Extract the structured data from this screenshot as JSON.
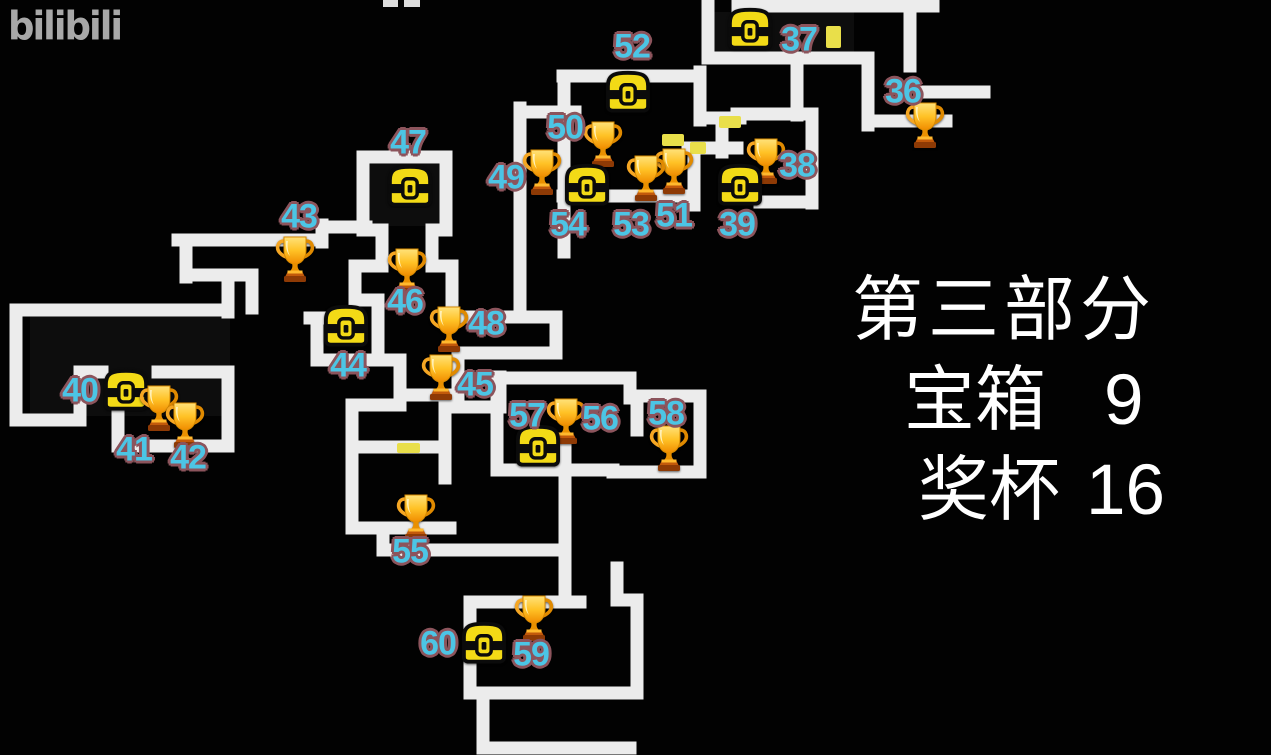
{
  "watermark": {
    "text": "bilibili"
  },
  "panel": {
    "title": "第三部分",
    "rows": [
      {
        "label": "宝箱",
        "value": "9"
      },
      {
        "label": "奖杯",
        "value": "16"
      }
    ]
  },
  "colors": {
    "background": "#020202",
    "wall": "#ECECEC",
    "door": "#E9DF4A",
    "label_fill": "#4CC5E5",
    "label_outline": "#8C545C",
    "chest_yellow": "#F3DA16",
    "trophy_gold": "#FFC226",
    "panel_text": "#FFFFFF",
    "watermark_gray": "#A8A8A8"
  },
  "map": {
    "doors": [
      {
        "x": 826,
        "y": 26,
        "w": 15,
        "h": 22
      },
      {
        "x": 719,
        "y": 116,
        "w": 22,
        "h": 12
      },
      {
        "x": 690,
        "y": 142,
        "w": 16,
        "h": 12
      },
      {
        "x": 662,
        "y": 134,
        "w": 22,
        "h": 12
      },
      {
        "x": 397,
        "y": 443,
        "w": 23,
        "h": 10
      }
    ]
  },
  "markers": [
    {
      "n": "36",
      "t": "trophy",
      "ix": 925,
      "iy": 124,
      "lx": 903,
      "ly": 92
    },
    {
      "n": "37",
      "t": "chest",
      "ix": 750,
      "iy": 28,
      "lx": 799,
      "ly": 40
    },
    {
      "n": "38",
      "t": "trophy",
      "ix": 766,
      "iy": 160,
      "lx": 797,
      "ly": 166
    },
    {
      "n": "39",
      "t": "chest",
      "ix": 740,
      "iy": 184,
      "lx": 737,
      "ly": 225
    },
    {
      "n": "40",
      "t": "chest",
      "ix": 126,
      "iy": 389,
      "lx": 80,
      "ly": 391
    },
    {
      "n": "41",
      "t": "trophy",
      "ix": 159,
      "iy": 407,
      "lx": 134,
      "ly": 450
    },
    {
      "n": "42",
      "t": "trophy",
      "ix": 185,
      "iy": 424,
      "lx": 188,
      "ly": 458
    },
    {
      "n": "43",
      "t": "trophy",
      "ix": 295,
      "iy": 258,
      "lx": 299,
      "ly": 217
    },
    {
      "n": "44",
      "t": "chest",
      "ix": 346,
      "iy": 325,
      "lx": 348,
      "ly": 366
    },
    {
      "n": "45",
      "t": "trophy",
      "ix": 441,
      "iy": 376,
      "lx": 475,
      "ly": 385
    },
    {
      "n": "46",
      "t": "trophy",
      "ix": 407,
      "iy": 270,
      "lx": 405,
      "ly": 302
    },
    {
      "n": "47",
      "t": "chest",
      "ix": 410,
      "iy": 185,
      "lx": 408,
      "ly": 143
    },
    {
      "n": "48",
      "t": "trophy",
      "ix": 449,
      "iy": 328,
      "lx": 486,
      "ly": 324
    },
    {
      "n": "49",
      "t": "trophy",
      "ix": 542,
      "iy": 171,
      "lx": 506,
      "ly": 178
    },
    {
      "n": "50",
      "t": "trophy",
      "ix": 603,
      "iy": 143,
      "lx": 565,
      "ly": 128
    },
    {
      "n": "51",
      "t": "trophy",
      "ix": 674,
      "iy": 170,
      "lx": 674,
      "ly": 216
    },
    {
      "n": "52",
      "t": "chest",
      "ix": 628,
      "iy": 91,
      "lx": 632,
      "ly": 47
    },
    {
      "n": "53",
      "t": "trophy",
      "ix": 646,
      "iy": 177,
      "lx": 631,
      "ly": 225
    },
    {
      "n": "54",
      "t": "chest",
      "ix": 587,
      "iy": 184,
      "lx": 568,
      "ly": 225
    },
    {
      "n": "55",
      "t": "trophy",
      "ix": 416,
      "iy": 516,
      "lx": 410,
      "ly": 552
    },
    {
      "n": "56",
      "t": "trophy",
      "ix": 566,
      "iy": 420,
      "lx": 600,
      "ly": 419
    },
    {
      "n": "57",
      "t": "chest",
      "ix": 538,
      "iy": 445,
      "lx": 527,
      "ly": 416
    },
    {
      "n": "58",
      "t": "trophy",
      "ix": 669,
      "iy": 447,
      "lx": 666,
      "ly": 414
    },
    {
      "n": "59",
      "t": "trophy",
      "ix": 534,
      "iy": 617,
      "lx": 531,
      "ly": 655
    },
    {
      "n": "60",
      "t": "chest",
      "ix": 484,
      "iy": 642,
      "lx": 438,
      "ly": 644
    }
  ]
}
